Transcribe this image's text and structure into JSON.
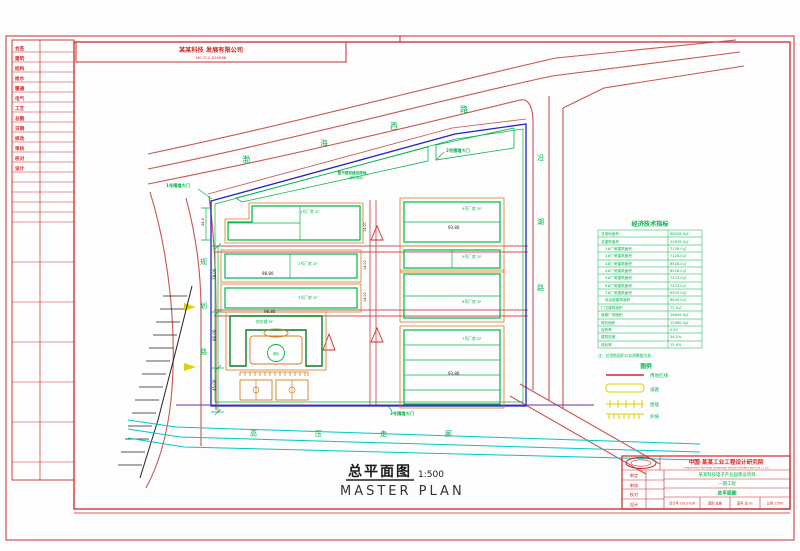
{
  "sheet": {
    "header": {
      "company": "某某科技 发展有限公司",
      "number": "NO.7C2-K20568"
    },
    "strip_rows": [
      "会签",
      "建筑",
      "结构",
      "给水",
      "暖通",
      "电气",
      "工艺",
      "总图",
      "日期",
      "修改",
      "审核",
      "校对",
      "设计"
    ]
  },
  "roads": {
    "north": [
      "渤",
      "海",
      "西",
      "路"
    ],
    "east": [
      "沿",
      "湖",
      "路"
    ],
    "west": [
      "规",
      "划",
      "路"
    ],
    "corridor": [
      "高",
      "压",
      "走",
      "廊"
    ]
  },
  "site": {
    "gate1": "1号围墙大门",
    "gate2": "2号围墙大门",
    "gate3": "3号围墙大门",
    "reserve1": "暂不规划建设用地",
    "reserve2": "（绿化用地）",
    "pool": "绿化"
  },
  "buildings": {
    "b1": "1号厂房 2F",
    "b2": "2号厂房 2F",
    "b3": "3号厂房 2F",
    "r1": "4号厂房 3F",
    "r2": "5号厂房 1F",
    "r3": "6号厂房 3F",
    "r4": "7号厂房 2F",
    "office": "综合楼 5F"
  },
  "dims": {
    "d1": "98.80",
    "d2": "93.80",
    "d3": "93.80",
    "d4": "98.80",
    "v1": "78.00",
    "v2": "66.00",
    "v3": "45.00",
    "v4": "24.0",
    "m1": "14.00",
    "m2": "14.00",
    "m3": "14.00"
  },
  "table": {
    "title": "经济技术指标",
    "rows": [
      {
        "label": "总用地面积",
        "value": "86528.0㎡"
      },
      {
        "label": "总建筑面积",
        "value": "52876.0㎡"
      },
      {
        "label": "1#厂房建筑面积",
        "value": "7128.0㎡"
      },
      {
        "label": "2#厂房建筑面积",
        "value": "7128.0㎡"
      },
      {
        "label": "3#厂房建筑面积",
        "value": "6528.0㎡"
      },
      {
        "label": "4#厂房建筑面积",
        "value": "6528.0㎡"
      },
      {
        "label": "5#厂房建筑面积",
        "value": "7423.0㎡"
      },
      {
        "label": "6#厂房建筑面积",
        "value": "7423.0㎡"
      },
      {
        "label": "7#厂房建筑面积",
        "value": "6520.0㎡"
      },
      {
        "label": "综合楼建筑面积",
        "value": "8645.0㎡"
      },
      {
        "label": "门卫建筑面积",
        "value": "72.0㎡"
      },
      {
        "label": "道路广场面积",
        "value": "18645.0㎡"
      },
      {
        "label": "绿化面积",
        "value": "12980.0㎡"
      },
      {
        "label": "容积率",
        "value": "0.61"
      },
      {
        "label": "建筑密度",
        "value": "34.2%"
      },
      {
        "label": "绿化率",
        "value": "15.0%"
      }
    ],
    "footnote": "注：总用地面积以实测数据为准"
  },
  "legend": {
    "title": "图例",
    "items": [
      "用地红线",
      "道路",
      "围墙",
      "护坡"
    ]
  },
  "title_area": {
    "cn": "总平面图",
    "scale": "1:500",
    "en": "MASTER PLAN"
  },
  "title_block": {
    "institute": "中国·某某工业工程设计研究院",
    "institute_en": "CHINA MOUMOU INDUSTRIAL ENGINEERING DESIGN & RESEARCH INSTITUTE CO.,LTD",
    "roles": [
      "审定",
      "审核",
      "校对",
      "设计"
    ],
    "project": "某某科技电子产业园建设项目",
    "phase": "一期工程",
    "drawing": "总平面图",
    "cells": [
      "设计号 2013-028",
      "图别 总施",
      "图号 总-01",
      "比例 1:500"
    ]
  },
  "colors": {
    "road_red": "#c95353",
    "frame_red": "#cc2a2a",
    "cad_green": "#00b44c",
    "boundary_blue": "#2222c4",
    "corridor_cyan": "#00c8c8",
    "curb_orange": "#d2801e",
    "legend_yellow": "#ddd400"
  }
}
